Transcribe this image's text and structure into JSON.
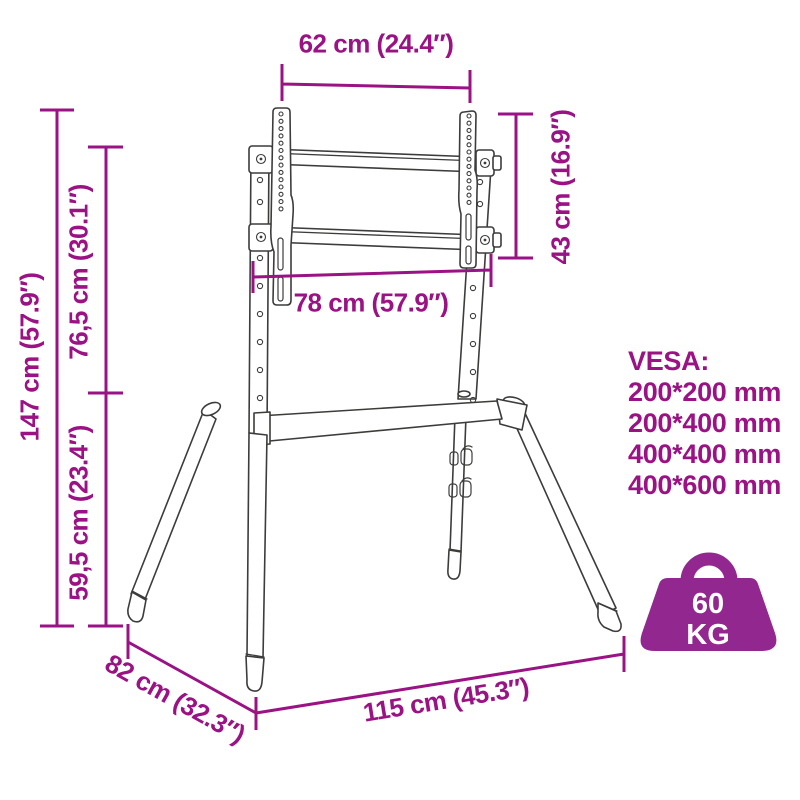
{
  "diagram": {
    "dims": {
      "mount_width": "62 cm (24.4″)",
      "total_height": "147 cm (57.9″)",
      "upper_section_height": "76,5 cm (30.1″)",
      "lower_section_height": "59,5 cm (23.4″)",
      "bracket_height": "43 cm (16.9″)",
      "frame_width": "78 cm (57.9″)",
      "base_width": "115 cm (45.3″)",
      "base_depth": "82 cm (32.3″)"
    },
    "vesa": {
      "heading": "VESA:",
      "sizes": [
        "200*200 mm",
        "200*400 mm",
        "400*400 mm",
        "400*600 mm"
      ]
    },
    "weight": {
      "value": "60",
      "unit": "KG"
    },
    "colors": {
      "accent": "#9A1284",
      "weight_icon": "#92278F",
      "line_art": "#3C3C3B",
      "background": "#FFFFFF"
    }
  }
}
